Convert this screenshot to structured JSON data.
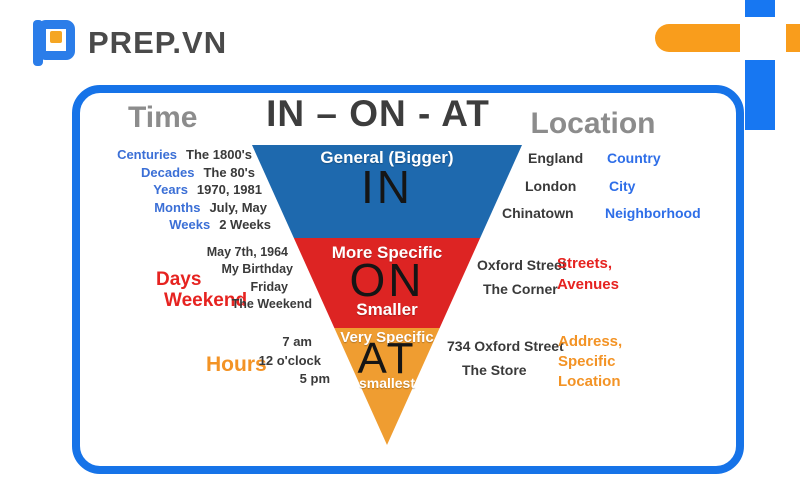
{
  "logo": {
    "text": "PREP.VN"
  },
  "colors": {
    "accent_blue": "#1673e8",
    "logo_blue": "#2b7de9",
    "logo_orange": "#f5a623",
    "deco_orange": "#f99d1c",
    "pyramid_in_blue": "#1e69ae",
    "pyramid_on_red": "#dd2423",
    "pyramid_at_orange": "#ef9d31",
    "term_blue": "#3b6fd6",
    "term_red": "#e62320",
    "term_orange": "#f39325",
    "heading_gray": "#8c8c8c",
    "text_dark": "#3a3a3a"
  },
  "poster": {
    "title": "IN – ON - AT",
    "time_heading": "Time",
    "location_heading": "Location",
    "pyramid": {
      "in": {
        "size_label": "General (Bigger)",
        "word": "IN"
      },
      "on": {
        "size_label": "More Specific",
        "word": "ON",
        "size_label_2": "Smaller"
      },
      "at": {
        "size_label": "Very Specific",
        "word": "AT",
        "size_label_2": "smallest"
      }
    },
    "time": {
      "in": {
        "terms": [
          "Centuries",
          "Decades",
          "Years",
          "Months",
          "Weeks"
        ],
        "examples": [
          "The 1800's",
          "The 80's",
          "1970, 1981",
          "July, May",
          "2 Weeks"
        ]
      },
      "on": {
        "terms": [
          "Days",
          "Weekend"
        ],
        "examples": [
          "May 7th, 1964",
          "My Birthday",
          "Friday",
          "The Weekend"
        ]
      },
      "at": {
        "term": "Hours",
        "examples": [
          "7 am",
          "12 o'clock",
          "5 pm"
        ]
      }
    },
    "location": {
      "in": {
        "examples": [
          "England",
          "London",
          "Chinatown"
        ],
        "categories": [
          "Country",
          "City",
          "Neighborhood"
        ]
      },
      "on": {
        "examples": [
          "Oxford Street",
          "The Corner"
        ],
        "category_lines": [
          "Streets,",
          "Avenues"
        ]
      },
      "at": {
        "examples": [
          "734 Oxford Street",
          "The Store"
        ],
        "category_lines": [
          "Address,",
          "Specific",
          "Location"
        ]
      }
    }
  }
}
